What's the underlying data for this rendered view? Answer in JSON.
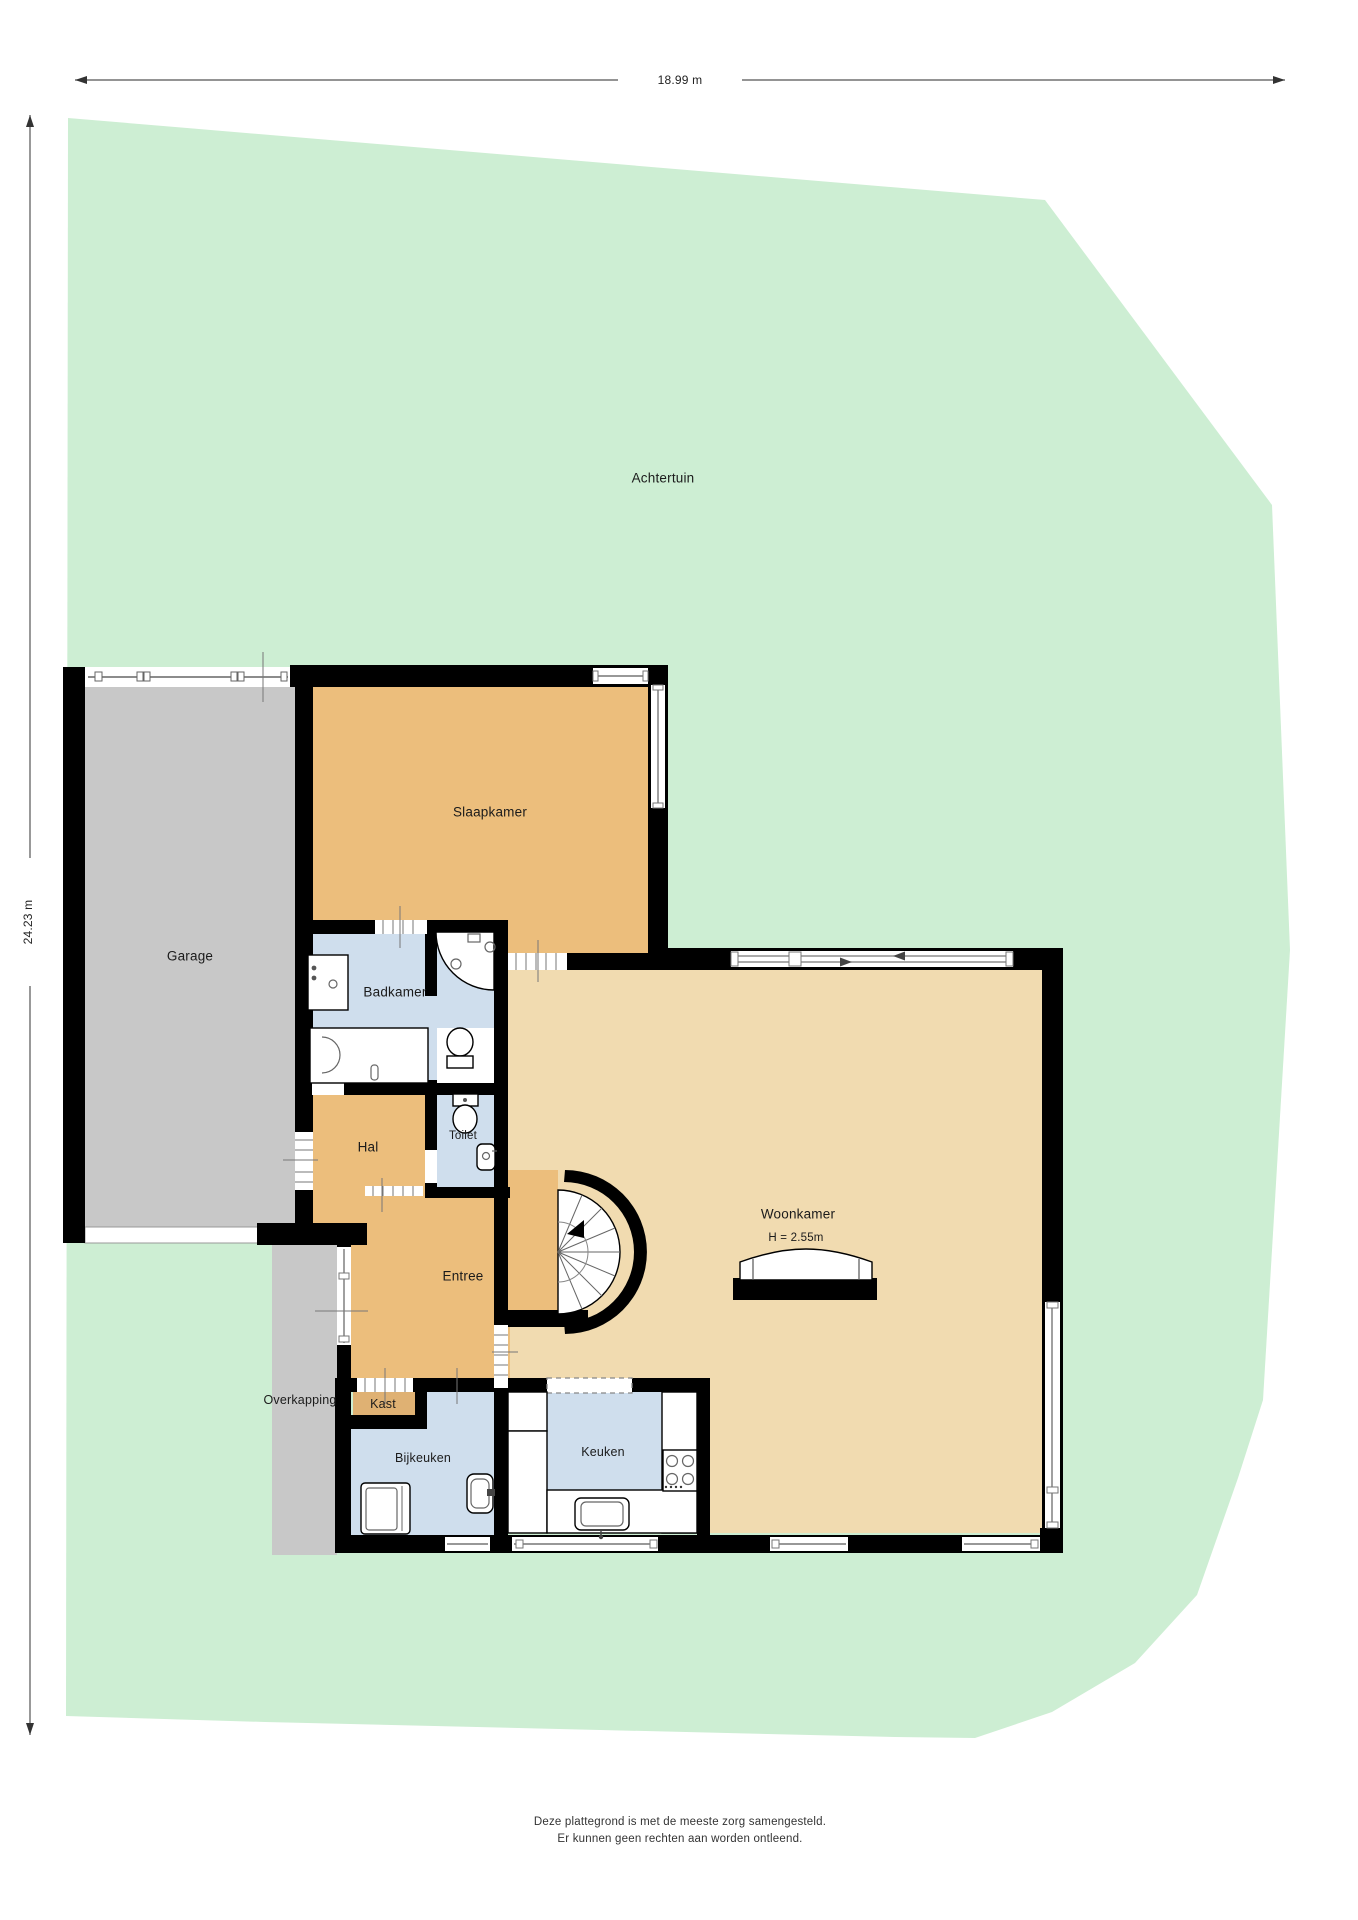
{
  "plan": {
    "title": "Plattegrond begane grond",
    "dimensions": {
      "width_label": "18.99 m",
      "height_label": "24.23 m"
    },
    "rooms": {
      "achtertuin": "Achtertuin",
      "garage": "Garage",
      "slaapkamer": "Slaapkamer",
      "badkamer": "Badkamer",
      "toilet": "Toilet",
      "hal": "Hal",
      "entree": "Entree",
      "overkapping": "Overkapping",
      "kast": "Kast",
      "bijkeuken": "Bijkeuken",
      "keuken": "Keuken",
      "woonkamer": "Woonkamer",
      "woonkamer_height": "H = 2.55m"
    },
    "footer": {
      "line1": "Deze plattegrond is met de meeste zorg samengesteld.",
      "line2": "Er kunnen geen rechten aan worden ontleend."
    },
    "colors": {
      "garden": "#cdeed3",
      "floor_orange": "#ecbe7c",
      "floor_tan": "#f1dbb0",
      "floor_blue": "#cfdeed",
      "floor_gray": "#c8c8c8",
      "kast_orange": "#dfb173",
      "wall": "#000000"
    }
  }
}
